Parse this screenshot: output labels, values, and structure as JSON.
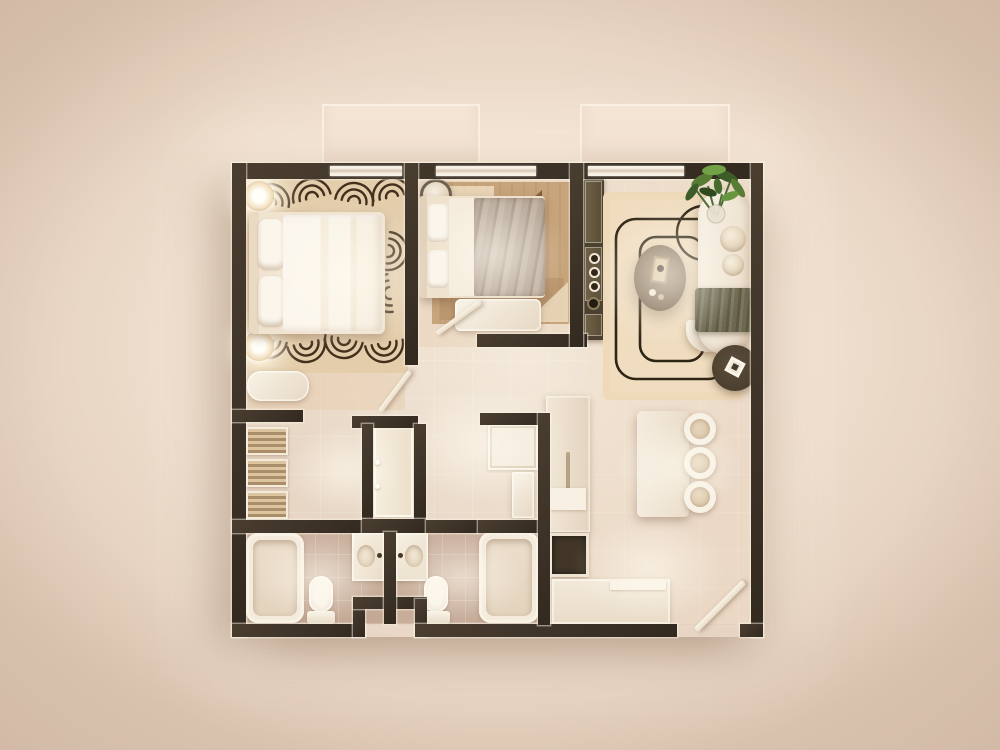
{
  "meta": {
    "type": "floor-plan-render",
    "view": "top-down"
  },
  "palette": {
    "bg-center": "#f6e9d9",
    "bg-mid": "#eeddcc",
    "bg-outer": "#e5d1bf",
    "wall": "#3e3328",
    "glass": "#d7c7b4",
    "floor": "#ebdbca",
    "bath-floor": "#cdb3a1",
    "furn-shade": "#e7d8c3",
    "rug-master": "#e3cdab",
    "rug-lines": "#42301d",
    "rug-br2": "#c7a47b",
    "rug-br2-dark": "#745536",
    "rug-br2-cream": "#ead7ba",
    "rug-living": "#eed9b9",
    "rug-living-line": "#2f2515",
    "blanket-olive": "#6c674e",
    "coffee-table": "#7e6c55",
    "side-table": "#4a3e2e",
    "console": "#4c4130",
    "console-panel": "#5a4d37",
    "cooktop": "#413628",
    "plant-dark": "#3c5c28",
    "plant-mid": "#567d33",
    "plant-light": "#73a147",
    "lamp-glow": "#fff8ec"
  },
  "scene": {
    "rooms": [
      {
        "name": "master-bedroom",
        "furniture": [
          "double-bed",
          "pillows",
          "nightstand-lamp-top",
          "nightstand-lamp-bottom",
          "wave-pattern-rug",
          "foot-bench"
        ]
      },
      {
        "name": "bedroom-2",
        "furniture": [
          "single-bed",
          "round-pouf",
          "geometric-rug",
          "foot-bench"
        ]
      },
      {
        "name": "living-room",
        "furniture": [
          "sofa",
          "olive-throw-blanket",
          "oval-coffee-table",
          "round-side-table",
          "media-console",
          "potted-plant",
          "outline-pattern-rug"
        ]
      },
      {
        "name": "dining-area",
        "furniture": [
          "dining-table",
          "round-chair",
          "round-chair",
          "round-chair"
        ]
      },
      {
        "name": "kitchen",
        "furniture": [
          "tall-cabinet-run",
          "dark-cooktop",
          "l-counter",
          "backsplash"
        ]
      },
      {
        "name": "hallway",
        "furniture": [
          "built-in-wardrobe",
          "storage-box",
          "small-cabinet"
        ]
      },
      {
        "name": "walk-in-closet",
        "furniture": [
          "slatted-shelf",
          "slatted-shelf",
          "slatted-shelf"
        ]
      },
      {
        "name": "bathroom-1",
        "furniture": [
          "bathtub",
          "toilet",
          "vanity-sink"
        ]
      },
      {
        "name": "bathroom-2",
        "furniture": [
          "bathtub",
          "toilet",
          "vanity-sink"
        ]
      },
      {
        "name": "balcony-north-west",
        "furniture": []
      },
      {
        "name": "balcony-north-east",
        "furniture": []
      }
    ],
    "doors": [
      "master-bedroom-door",
      "bedroom-2-door",
      "entry-door"
    ],
    "window_count": 3
  }
}
